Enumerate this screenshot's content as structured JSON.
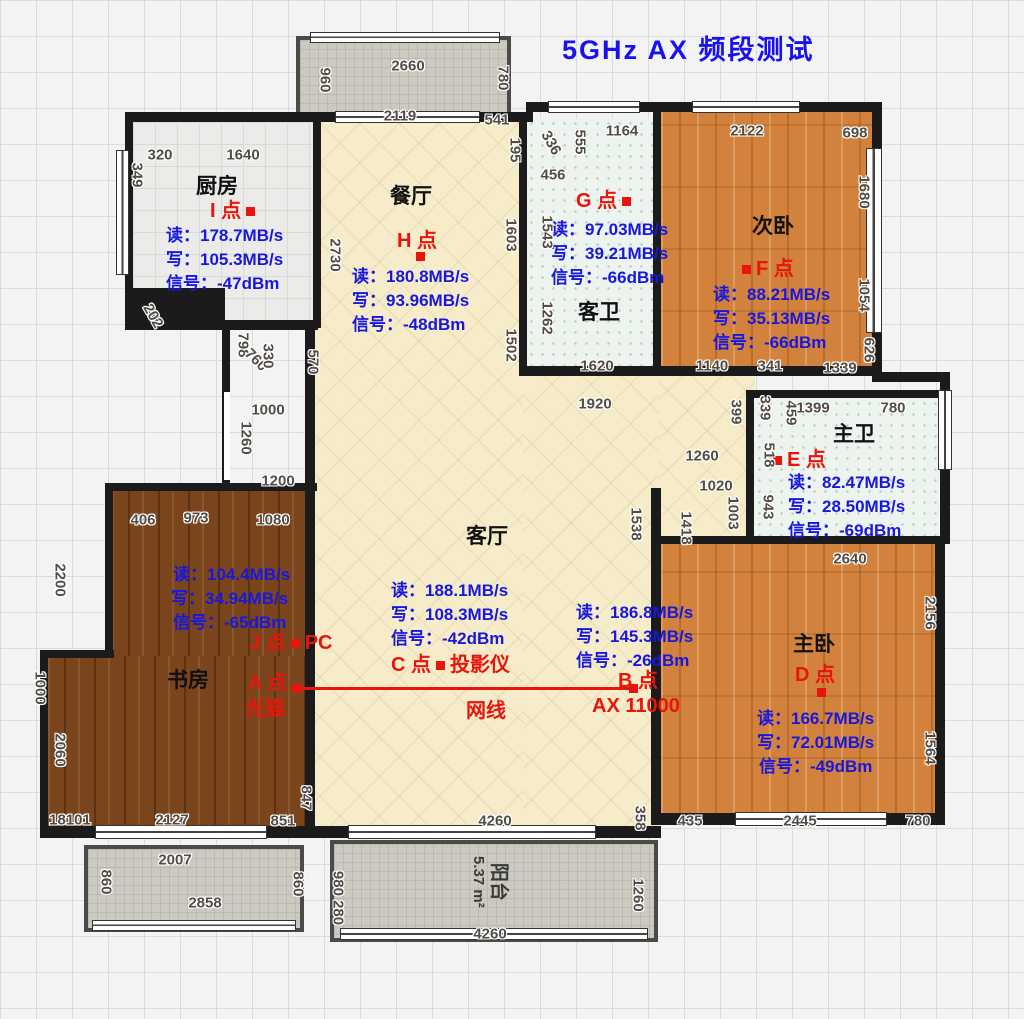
{
  "title": "5GHz AX 频段测试",
  "rooms": {
    "kitchen": "厨房",
    "dining": "餐厅",
    "guest_bath": "客卫",
    "second_bedroom": "次卧",
    "master_bath": "主卫",
    "living": "客厅",
    "study": "书房",
    "master_bedroom": "主卧",
    "balcony": "阳台",
    "balcony_area": "5.37 m²"
  },
  "cable": "网线",
  "points": {
    "A": {
      "label": "A 点",
      "device": "光猫"
    },
    "B": {
      "label": "B 点",
      "device": "AX 11000",
      "read": "读：186.8MB/s",
      "write": "写：145.3MB/s",
      "signal": "信号：-26dBm"
    },
    "C": {
      "label": "C 点",
      "device": "投影仪",
      "read": "读：188.1MB/s",
      "write": "写：108.3MB/s",
      "signal": "信号：-42dBm"
    },
    "D": {
      "label": "D 点",
      "read": "读：166.7MB/s",
      "write": "写：72.01MB/s",
      "signal": "信号：-49dBm"
    },
    "E": {
      "label": "E 点",
      "read": "读：82.47MB/s",
      "write": "写：28.50MB/s",
      "signal": "信号：-69dBm"
    },
    "F": {
      "label": "F 点",
      "read": "读：88.21MB/s",
      "write": "写：35.13MB/s",
      "signal": "信号：-66dBm"
    },
    "G": {
      "label": "G 点",
      "read": "读：97.03MB/s",
      "write": "写：39.21MB/s",
      "signal": "信号：-66dBm"
    },
    "H": {
      "label": "H 点",
      "read": "读：180.8MB/s",
      "write": "写：93.96MB/s",
      "signal": "信号：-48dBm"
    },
    "I": {
      "label": "I 点",
      "read": "读：178.7MB/s",
      "write": "写：105.3MB/s",
      "signal": "信号：-47dBm"
    },
    "J": {
      "label": "J 点",
      "device": "PC",
      "read": "读：104.4MB/s",
      "write": "写：34.94MB/s",
      "signal": "信号：-65dBm"
    }
  },
  "dimensions": [
    {
      "t": "960",
      "x": 325,
      "y": 80,
      "r": 90
    },
    {
      "t": "2660",
      "x": 408,
      "y": 66,
      "r": 0
    },
    {
      "t": "780",
      "x": 503,
      "y": 78,
      "r": 90
    },
    {
      "t": "2119",
      "x": 400,
      "y": 116,
      "r": 0
    },
    {
      "t": "541",
      "x": 497,
      "y": 120,
      "r": 0
    },
    {
      "t": "195",
      "x": 515,
      "y": 150,
      "r": 90
    },
    {
      "t": "320",
      "x": 160,
      "y": 155,
      "r": 0
    },
    {
      "t": "1640",
      "x": 243,
      "y": 155,
      "r": 0
    },
    {
      "t": "349",
      "x": 137,
      "y": 175,
      "r": 90
    },
    {
      "t": "336",
      "x": 551,
      "y": 143,
      "r": 60
    },
    {
      "t": "555",
      "x": 580,
      "y": 142,
      "r": 90
    },
    {
      "t": "1164",
      "x": 622,
      "y": 131,
      "r": 0
    },
    {
      "t": "456",
      "x": 553,
      "y": 175,
      "r": 0
    },
    {
      "t": "2122",
      "x": 747,
      "y": 131,
      "r": 0
    },
    {
      "t": "698",
      "x": 855,
      "y": 133,
      "r": 0
    },
    {
      "t": "1680",
      "x": 864,
      "y": 192,
      "r": 90
    },
    {
      "t": "1543",
      "x": 547,
      "y": 232,
      "r": 90
    },
    {
      "t": "2730",
      "x": 335,
      "y": 255,
      "r": 90
    },
    {
      "t": "1603",
      "x": 511,
      "y": 235,
      "r": 90
    },
    {
      "t": "1262",
      "x": 547,
      "y": 318,
      "r": 90
    },
    {
      "t": "1054",
      "x": 864,
      "y": 295,
      "r": 90
    },
    {
      "t": "626",
      "x": 869,
      "y": 350,
      "r": 90
    },
    {
      "t": "202",
      "x": 153,
      "y": 316,
      "r": 60
    },
    {
      "t": "798",
      "x": 243,
      "y": 345,
      "r": 90
    },
    {
      "t": "760",
      "x": 256,
      "y": 360,
      "r": 45
    },
    {
      "t": "330",
      "x": 268,
      "y": 356,
      "r": 90
    },
    {
      "t": "570",
      "x": 313,
      "y": 362,
      "r": 90
    },
    {
      "t": "1502",
      "x": 511,
      "y": 345,
      "r": 90
    },
    {
      "t": "1000",
      "x": 268,
      "y": 410,
      "r": 0
    },
    {
      "t": "1260",
      "x": 246,
      "y": 438,
      "r": 90
    },
    {
      "t": "1200",
      "x": 278,
      "y": 481,
      "r": 0
    },
    {
      "t": "1920",
      "x": 595,
      "y": 404,
      "r": 0
    },
    {
      "t": "1620",
      "x": 597,
      "y": 366,
      "r": 0
    },
    {
      "t": "1140",
      "x": 712,
      "y": 366,
      "r": 0
    },
    {
      "t": "341",
      "x": 770,
      "y": 366,
      "r": 0
    },
    {
      "t": "1339",
      "x": 840,
      "y": 368,
      "r": 0
    },
    {
      "t": "399",
      "x": 736,
      "y": 412,
      "r": 90
    },
    {
      "t": "339",
      "x": 765,
      "y": 408,
      "r": 90
    },
    {
      "t": "459",
      "x": 791,
      "y": 413,
      "r": 90
    },
    {
      "t": "518",
      "x": 769,
      "y": 455,
      "r": 90
    },
    {
      "t": "943",
      "x": 768,
      "y": 507,
      "r": 90
    },
    {
      "t": "1399",
      "x": 813,
      "y": 408,
      "r": 0
    },
    {
      "t": "780",
      "x": 893,
      "y": 408,
      "r": 0
    },
    {
      "t": "1260",
      "x": 702,
      "y": 456,
      "r": 0
    },
    {
      "t": "1020",
      "x": 716,
      "y": 486,
      "r": 0
    },
    {
      "t": "1003",
      "x": 733,
      "y": 513,
      "r": 90
    },
    {
      "t": "1538",
      "x": 636,
      "y": 524,
      "r": 90
    },
    {
      "t": "1418",
      "x": 686,
      "y": 528,
      "r": 90
    },
    {
      "t": "2640",
      "x": 850,
      "y": 559,
      "r": 0
    },
    {
      "t": "406",
      "x": 143,
      "y": 520,
      "r": 0
    },
    {
      "t": "973",
      "x": 196,
      "y": 518,
      "r": 0
    },
    {
      "t": "1080",
      "x": 273,
      "y": 520,
      "r": 0
    },
    {
      "t": "2200",
      "x": 60,
      "y": 580,
      "r": 90
    },
    {
      "t": "2156",
      "x": 930,
      "y": 613,
      "r": 90
    },
    {
      "t": "1000",
      "x": 40,
      "y": 688,
      "r": 90
    },
    {
      "t": "2060",
      "x": 60,
      "y": 750,
      "r": 90
    },
    {
      "t": "1564",
      "x": 930,
      "y": 748,
      "r": 90
    },
    {
      "t": "18101",
      "x": 70,
      "y": 820,
      "r": 0
    },
    {
      "t": "2127",
      "x": 172,
      "y": 820,
      "r": 0
    },
    {
      "t": "851",
      "x": 283,
      "y": 821,
      "r": 0
    },
    {
      "t": "847",
      "x": 306,
      "y": 798,
      "r": 90
    },
    {
      "t": "4260",
      "x": 495,
      "y": 821,
      "r": 0
    },
    {
      "t": "358",
      "x": 640,
      "y": 818,
      "r": 90
    },
    {
      "t": "435",
      "x": 690,
      "y": 821,
      "r": 0
    },
    {
      "t": "2445",
      "x": 800,
      "y": 821,
      "r": 0
    },
    {
      "t": "780",
      "x": 918,
      "y": 821,
      "r": 0
    },
    {
      "t": "2007",
      "x": 175,
      "y": 860,
      "r": 0
    },
    {
      "t": "860",
      "x": 106,
      "y": 882,
      "r": 90
    },
    {
      "t": "2858",
      "x": 205,
      "y": 903,
      "r": 0
    },
    {
      "t": "860",
      "x": 298,
      "y": 884,
      "r": 90
    },
    {
      "t": "980 280",
      "x": 338,
      "y": 898,
      "r": 90
    },
    {
      "t": "1260",
      "x": 638,
      "y": 895,
      "r": 90
    },
    {
      "t": "4260",
      "x": 490,
      "y": 934,
      "r": 0
    }
  ]
}
